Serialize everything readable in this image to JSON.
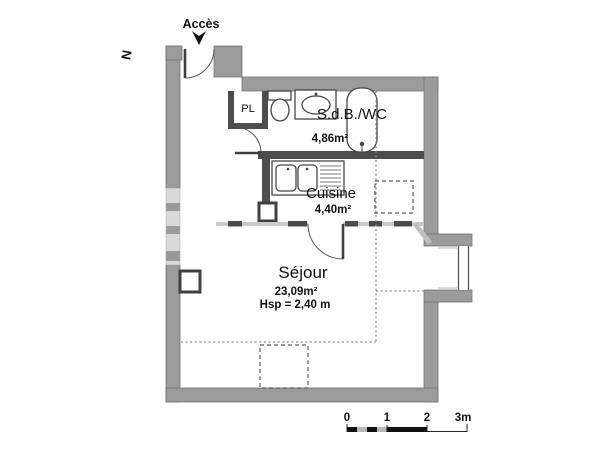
{
  "palette": {
    "wall": "#9b9b9b",
    "interior_partition": "#4d4d4d",
    "glazing": "#d9d9d9",
    "dashed_line": "#5a5a5a",
    "dotted_line": "#8a8a8a",
    "text": "#111111"
  },
  "plan": {
    "access_label": "Accès",
    "compass_label": "N",
    "rooms": {
      "bathroom": {
        "name": "S.d.B./WC",
        "area": "4,86m²"
      },
      "kitchen": {
        "name": "Cuisine",
        "area": "4,40m²"
      },
      "living": {
        "name": "Séjour",
        "area": "23,09m²",
        "ceiling_height": "Hsp = 2,40 m"
      },
      "closet": {
        "name": "PL"
      }
    },
    "scale_bar": {
      "ticks": [
        "0",
        "1",
        "2",
        "3m"
      ]
    }
  }
}
